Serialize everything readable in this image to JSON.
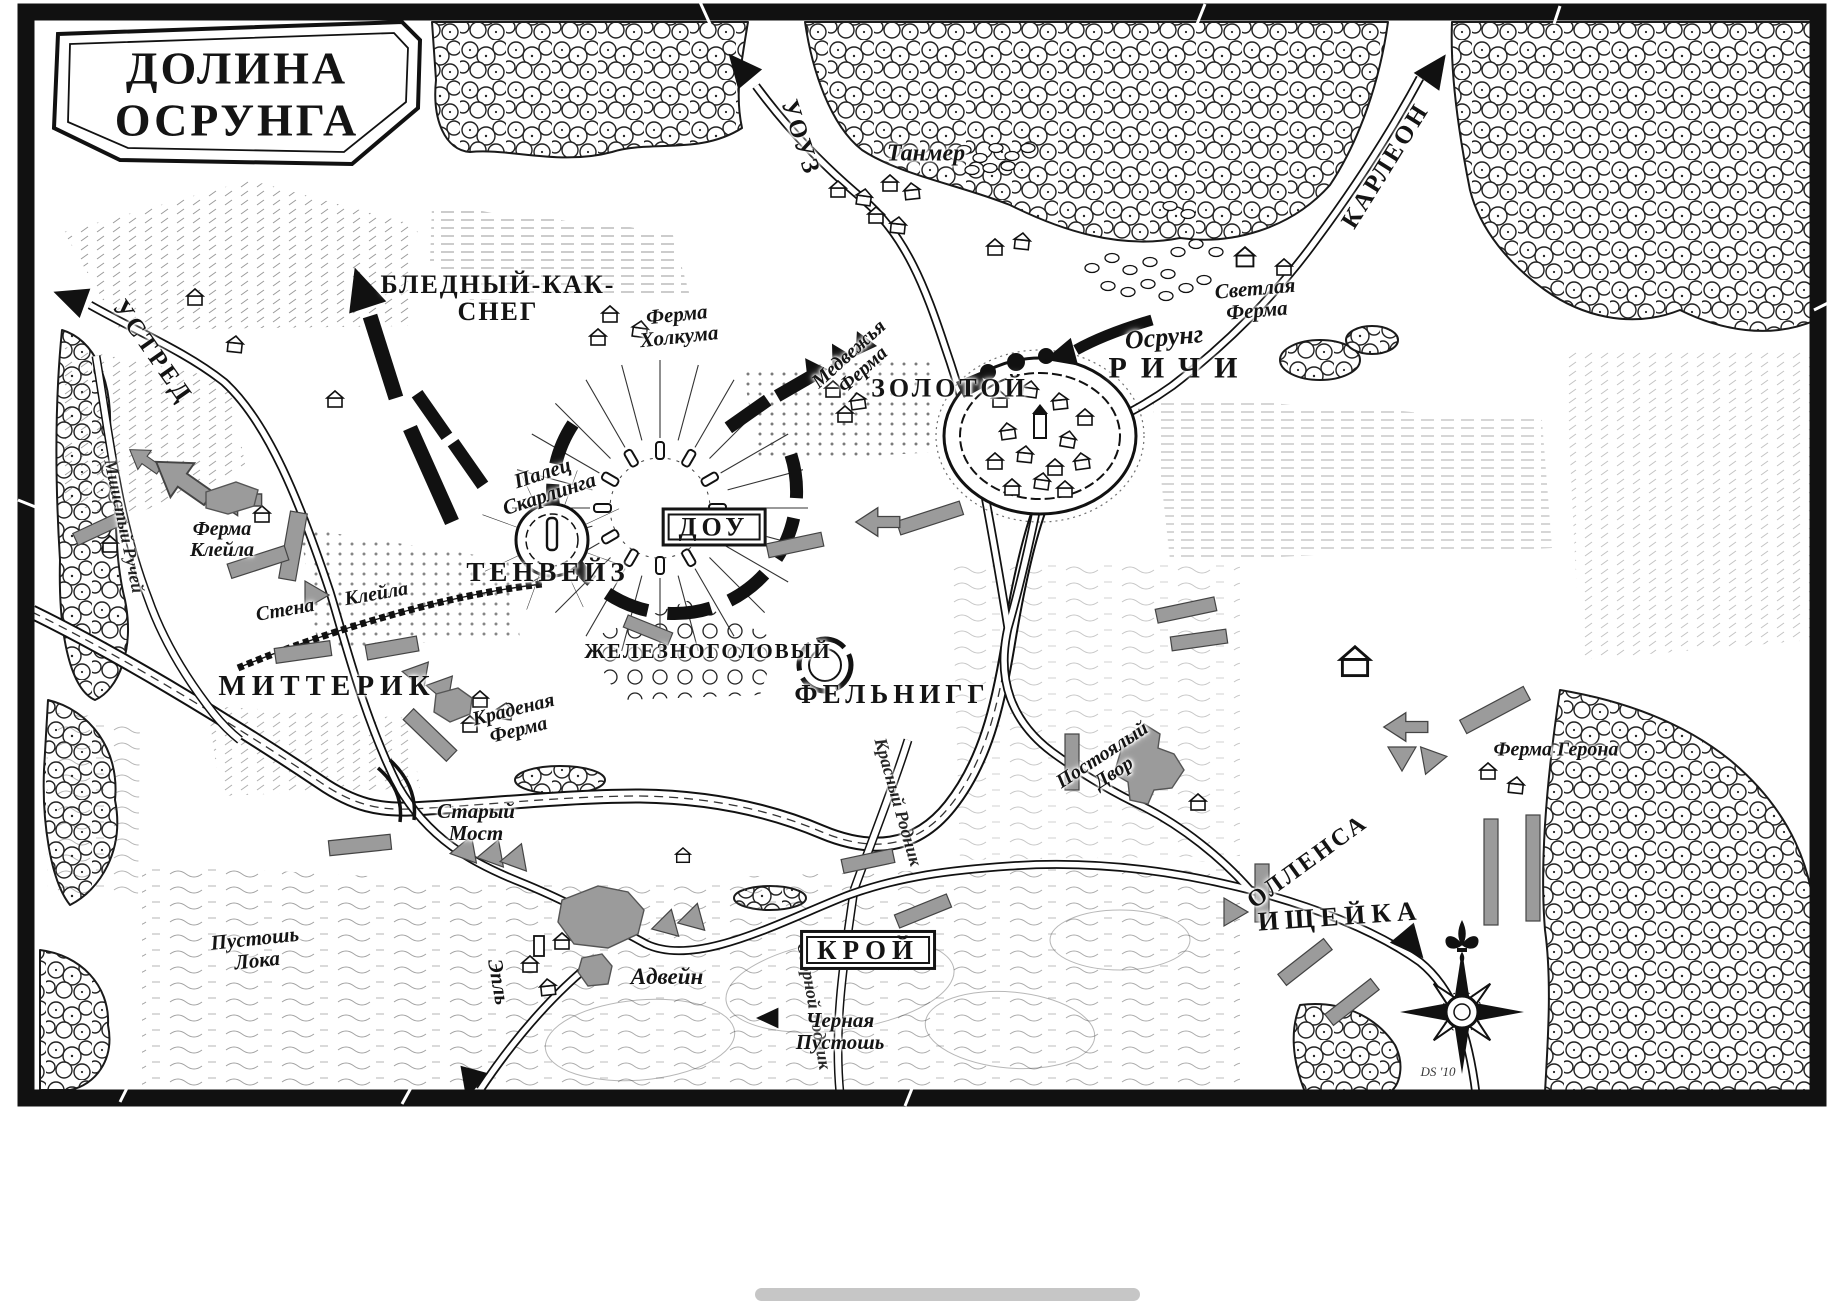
{
  "map": {
    "title": "ДОЛИНА\nОСРУНГА"
  },
  "roads": {
    "uouz": "УОУЗ",
    "karleon": "КАРЛЕОН",
    "ustred": "УСТРЕД",
    "ollensa": "ОЛЛЕНСА",
    "apl": "Эпль"
  },
  "rivers": {
    "mossy": "Мшистый Ручей",
    "krasny": "Красный Родник",
    "ozornoy": "Озорной Родник"
  },
  "northmen": {
    "pale_as_snow": "БЛЕДНЫЙ-КАК-\nСНЕГ",
    "tenways": "ТЕНВЕЙЗ",
    "dow": "ДОУ",
    "ironhead": "ЖЕЛЕЗНОГОЛОВЫЙ",
    "golden": "ЗОЛОТОЙ",
    "reachey": "РИЧИ"
  },
  "union": {
    "mitterick": "МИТТЕРИК",
    "felnigg": "ФЕЛЬНИГГ",
    "kroy": "КРОЙ",
    "dogman": "ИЩЕЙКА"
  },
  "places": {
    "tanmer": "Танмер",
    "svetlaya_farm": "Светлая\nФерма",
    "holkum_farm": "Ферма\nХолкума",
    "bear_farm": "Медвежья\nФерма",
    "skarling_finger": "Палец\nСкарлинга",
    "clail_farm": "Ферма\nКлейла",
    "clail_wall": "Стена Клейла",
    "stolen_farm": "Краденая\nФерма",
    "old_bridge": "Старый\nМост",
    "inn": "Постоялый\nДвор",
    "adwein": "Адвейн",
    "geron_farm": "Ферма Герона",
    "lok_waste": "Пустошь\nЛока",
    "black_waste": "Черная\nПустошь",
    "osrung_town": "Осрунг"
  },
  "signature": "DS '10",
  "icons": {
    "compass": "compass-rose-icon",
    "fleur": "fleur-de-lis-icon"
  },
  "colors": {
    "ink": "#141414",
    "paper": "#ffffff",
    "union_grey": "#9b9b9b",
    "scrollbar": "#c6c6c6"
  }
}
